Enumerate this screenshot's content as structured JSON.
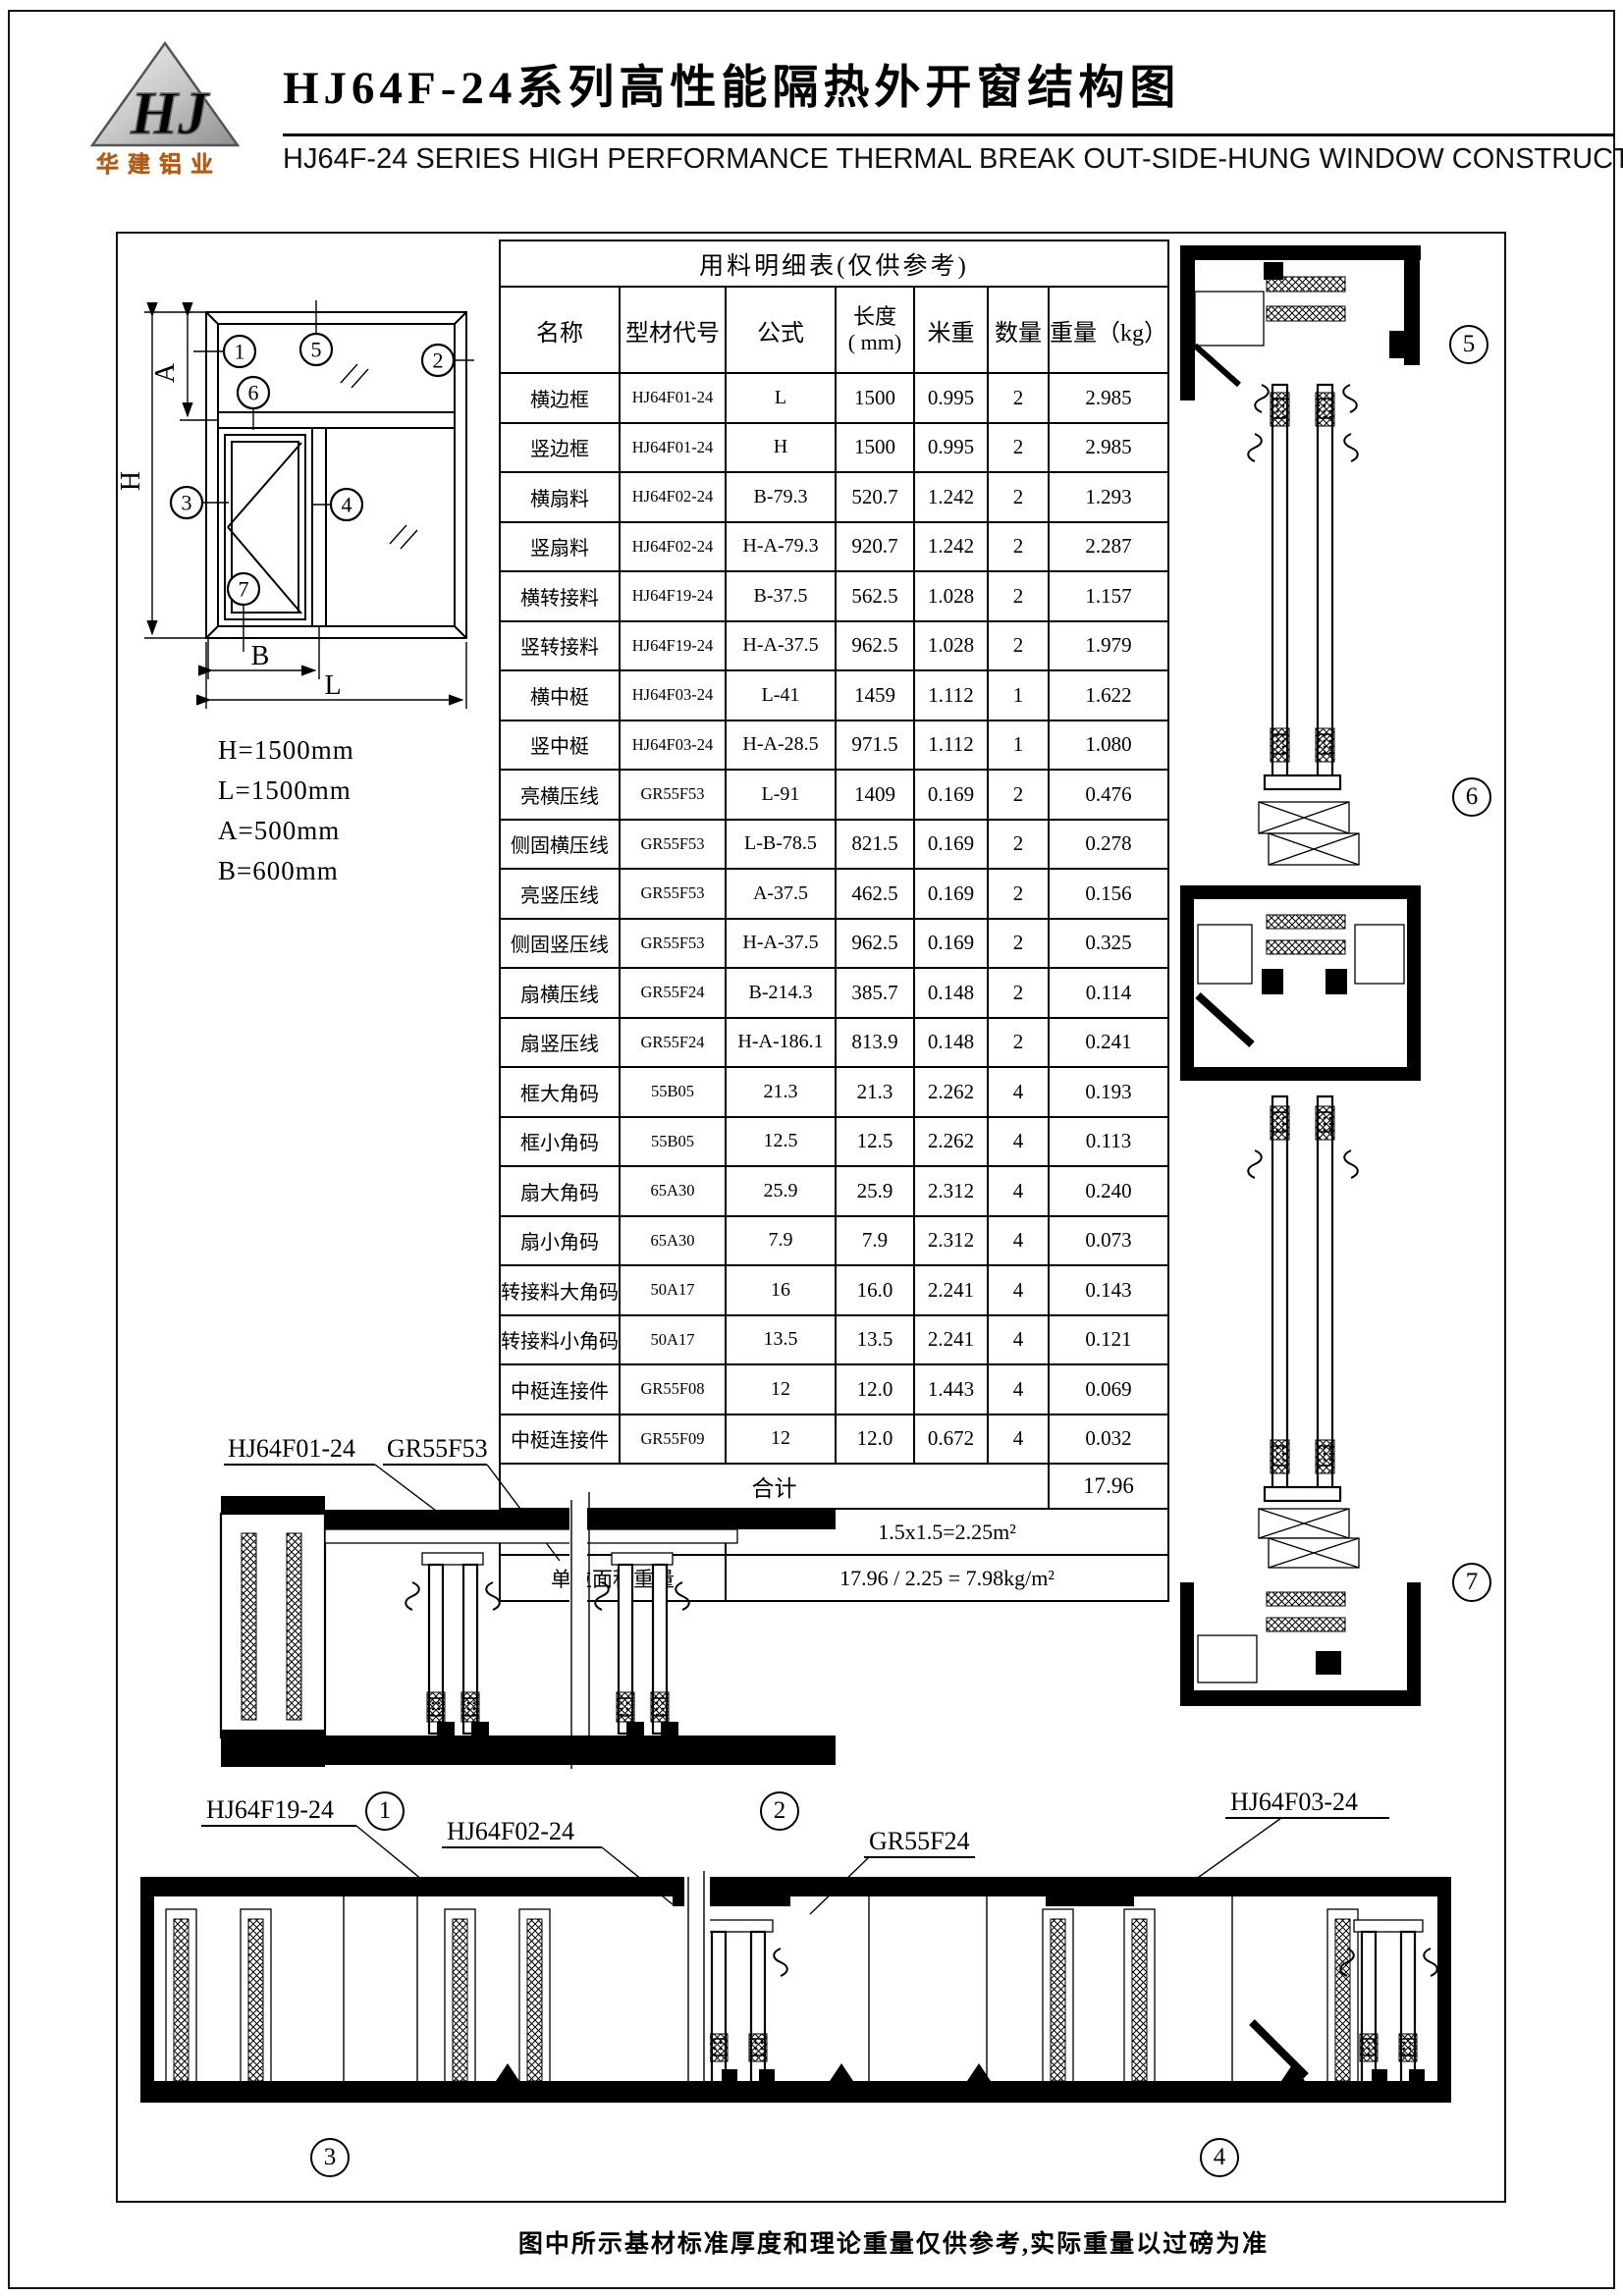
{
  "header": {
    "logo_mark": "HJ",
    "logo_text": "华建铝业",
    "title_cn": "HJ64F-24系列高性能隔热外开窗结构图",
    "title_en": "HJ64F-24 SERIES  HIGH PERFORMANCE THERMAL BREAK OUT-SIDE-HUNG WINDOW CONSTRUCTION"
  },
  "elevation": {
    "dims": {
      "h": "H",
      "a": "A",
      "b": "B",
      "l": "L"
    },
    "callouts": [
      "1",
      "2",
      "3",
      "4",
      "5",
      "6",
      "7"
    ],
    "notes": [
      "H=1500mm",
      "L=1500mm",
      "A=500mm",
      "B=600mm"
    ]
  },
  "table": {
    "title": "用料明细表(仅供参考)",
    "columns": [
      "名称",
      "型材代号",
      "公式",
      "长度\n( mm)",
      "米重",
      "数量",
      "重量（kg）"
    ],
    "rows": [
      [
        "横边框",
        "HJ64F01-24",
        "L",
        "1500",
        "0.995",
        "2",
        "2.985"
      ],
      [
        "竖边框",
        "HJ64F01-24",
        "H",
        "1500",
        "0.995",
        "2",
        "2.985"
      ],
      [
        "横扇料",
        "HJ64F02-24",
        "B-79.3",
        "520.7",
        "1.242",
        "2",
        "1.293"
      ],
      [
        "竖扇料",
        "HJ64F02-24",
        "H-A-79.3",
        "920.7",
        "1.242",
        "2",
        "2.287"
      ],
      [
        "横转接料",
        "HJ64F19-24",
        "B-37.5",
        "562.5",
        "1.028",
        "2",
        "1.157"
      ],
      [
        "竖转接料",
        "HJ64F19-24",
        "H-A-37.5",
        "962.5",
        "1.028",
        "2",
        "1.979"
      ],
      [
        "横中梃",
        "HJ64F03-24",
        "L-41",
        "1459",
        "1.112",
        "1",
        "1.622"
      ],
      [
        "竖中梃",
        "HJ64F03-24",
        "H-A-28.5",
        "971.5",
        "1.112",
        "1",
        "1.080"
      ],
      [
        "亮横压线",
        "GR55F53",
        "L-91",
        "1409",
        "0.169",
        "2",
        "0.476"
      ],
      [
        "侧固横压线",
        "GR55F53",
        "L-B-78.5",
        "821.5",
        "0.169",
        "2",
        "0.278"
      ],
      [
        "亮竖压线",
        "GR55F53",
        "A-37.5",
        "462.5",
        "0.169",
        "2",
        "0.156"
      ],
      [
        "侧固竖压线",
        "GR55F53",
        "H-A-37.5",
        "962.5",
        "0.169",
        "2",
        "0.325"
      ],
      [
        "扇横压线",
        "GR55F24",
        "B-214.3",
        "385.7",
        "0.148",
        "2",
        "0.114"
      ],
      [
        "扇竖压线",
        "GR55F24",
        "H-A-186.1",
        "813.9",
        "0.148",
        "2",
        "0.241"
      ],
      [
        "框大角码",
        "55B05",
        "21.3",
        "21.3",
        "2.262",
        "4",
        "0.193"
      ],
      [
        "框小角码",
        "55B05",
        "12.5",
        "12.5",
        "2.262",
        "4",
        "0.113"
      ],
      [
        "扇大角码",
        "65A30",
        "25.9",
        "25.9",
        "2.312",
        "4",
        "0.240"
      ],
      [
        "扇小角码",
        "65A30",
        "7.9",
        "7.9",
        "2.312",
        "4",
        "0.073"
      ],
      [
        "转接料大角码",
        "50A17",
        "16",
        "16.0",
        "2.241",
        "4",
        "0.143"
      ],
      [
        "转接料小角码",
        "50A17",
        "13.5",
        "13.5",
        "2.241",
        "4",
        "0.121"
      ],
      [
        "中梃连接件",
        "GR55F08",
        "12",
        "12.0",
        "1.443",
        "4",
        "0.069"
      ],
      [
        "中梃连接件",
        "GR55F09",
        "12",
        "12.0",
        "0.672",
        "4",
        "0.032"
      ]
    ],
    "total_label": "合计",
    "total_value": "17.96",
    "area_label": "铝窗面积",
    "area_value": "1.5x1.5=2.25m²",
    "unit_label": "单位面积重量",
    "unit_value": "17.96 / 2.25 = 7.98kg/m²"
  },
  "sections": {
    "profile_labels": [
      "HJ64F01-24",
      "GR55F53",
      "HJ64F19-24",
      "HJ64F02-24",
      "GR55F24",
      "HJ64F03-24"
    ],
    "right_callouts": [
      "5",
      "6",
      "7"
    ],
    "bottom_callouts": [
      "1",
      "2",
      "3",
      "4"
    ]
  },
  "footer": {
    "note": "图中所示基材标准厚度和理论重量仅供参考,实际重量以过磅为准"
  }
}
